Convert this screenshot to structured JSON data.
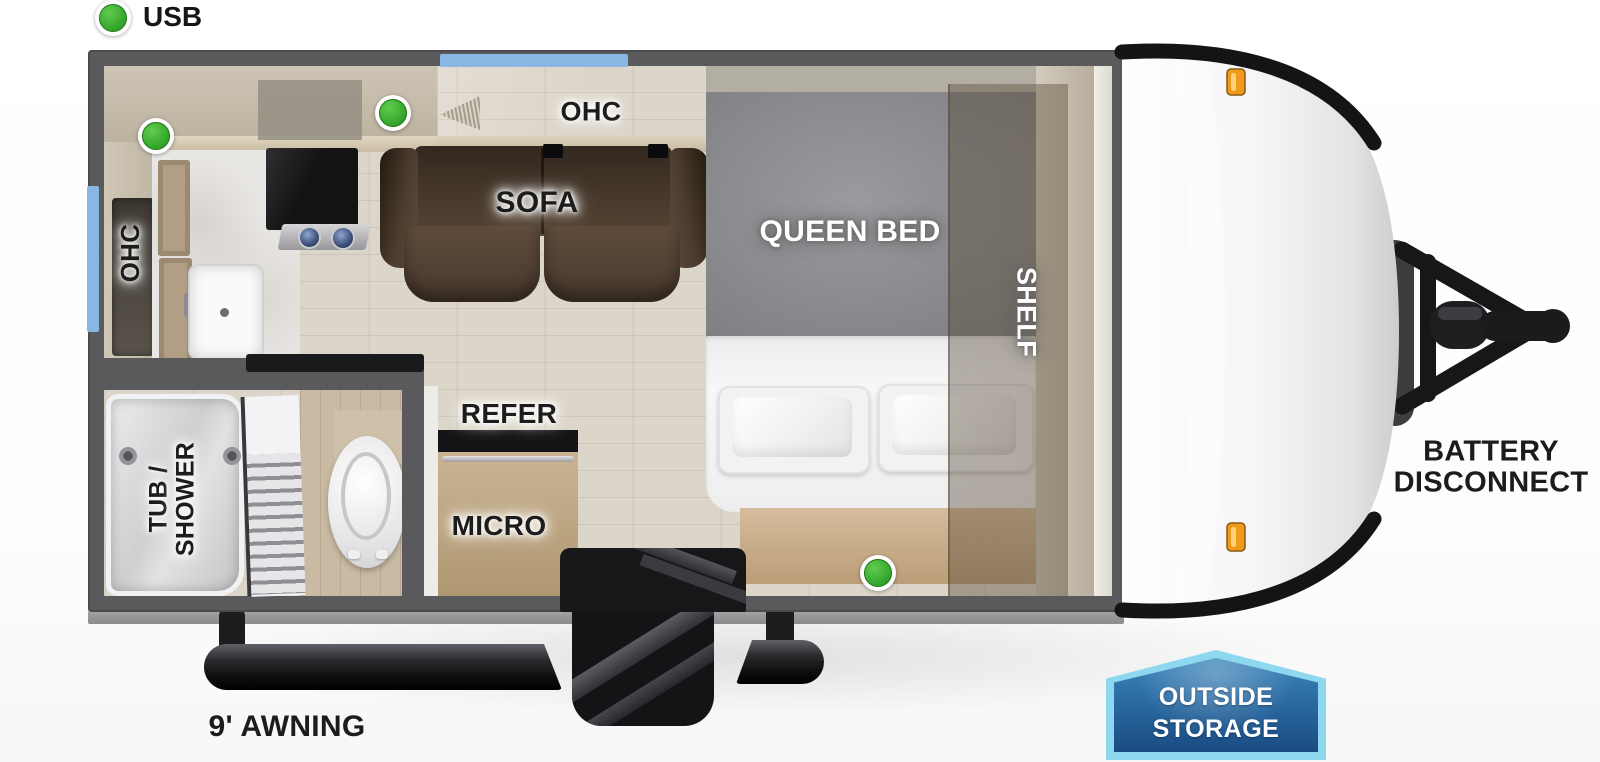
{
  "legend": {
    "usb": "USB"
  },
  "rooms": {
    "kitchen_ohc": "OHC",
    "living_ohc": "OHC",
    "sofa": "SOFA",
    "queen_bed": "QUEEN BED",
    "shelf": "SHELF",
    "refer": "REFER",
    "micro": "MICRO",
    "tub_shower": {
      "line1": "TUB /",
      "line2": "SHOWER"
    }
  },
  "exterior": {
    "awning": "9' AWNING",
    "battery_disconnect": {
      "line1": "BATTERY",
      "line2": "DISCONNECT"
    },
    "outside_storage": {
      "line1": "OUTSIDE",
      "line2": "STORAGE"
    }
  },
  "usb_ports": [
    {
      "location": "kitchen-counter"
    },
    {
      "location": "sofa-left"
    },
    {
      "location": "bed-foot"
    }
  ],
  "colors": {
    "usb_green": "#34a72d",
    "window_blue": "#87b7e2",
    "wall_gray": "#5a5a5c",
    "sofa_brown": "#4e3e30",
    "bed_gray": "#8a8a8e",
    "marker_light_orange": "#f09a1c",
    "storage_badge_border": "#8ed8ef",
    "storage_badge_fill": "#2a6ba2"
  }
}
